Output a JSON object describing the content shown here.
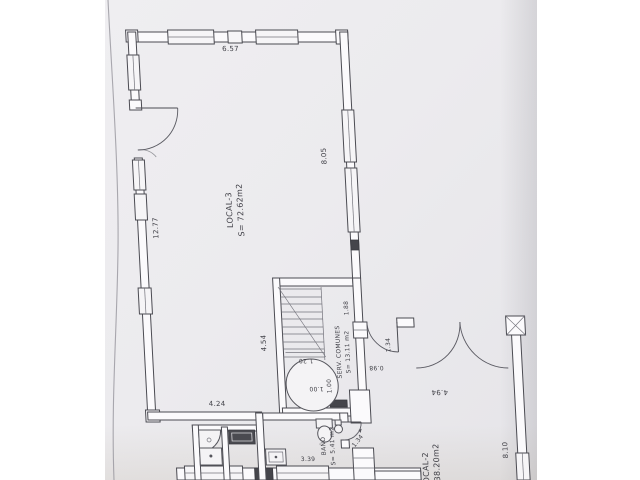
{
  "rooms": {
    "local3": {
      "name": "LOCAL-3",
      "area": "S= 72.62m2"
    },
    "serv": {
      "name": "SERV. COMUNES",
      "area": "S= 13.11 m2"
    },
    "bano": {
      "name": "BAÑO",
      "area": "S= 5.41 m2"
    },
    "local2": {
      "name": "LOCAL-2",
      "area": "S= 38.20m2"
    }
  },
  "dims": {
    "top_width": "6.57",
    "left_height": "12.77",
    "right_height": "8.05",
    "hall_height": "4.54",
    "hall_width": "4.24",
    "stair_side": "1.88",
    "stair_width": "1.20",
    "lift": "1.00",
    "shaft": "1.00",
    "serv_door": "1.34",
    "step": "0.98",
    "entrance": "4.94",
    "local2_height": "8.10",
    "bano_width": "3.39",
    "bano_door": "1.34"
  }
}
